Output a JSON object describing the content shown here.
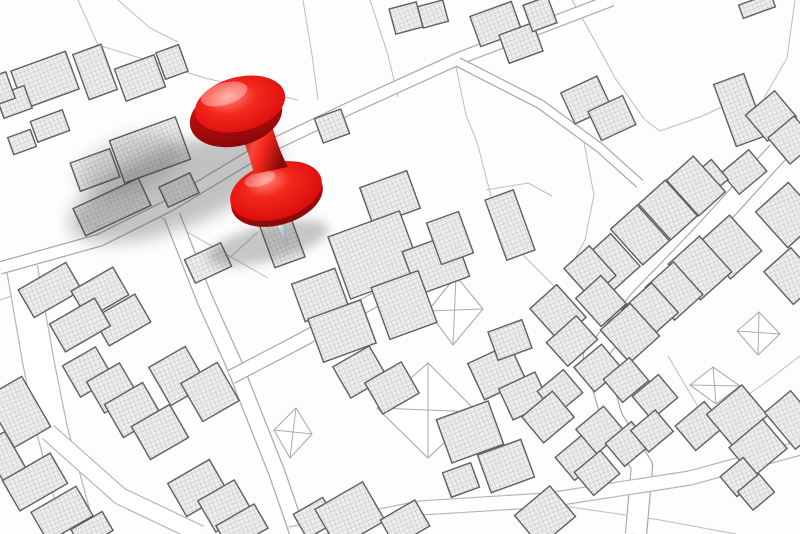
{
  "meta": {
    "alt": "Imaginary cadastral city map with hatched building footprints, parcel lines, white roads, X-marked vacant plots and a red pushpin marking a location near the top left",
    "width": 800,
    "height": 534
  },
  "palette": {
    "background": "#fdfdfd",
    "parcel_line": "#bdbdbd",
    "road_fill": "#ffffff",
    "road_casing": "#a8a8a8",
    "road_casing_wide": "#b5b5b5",
    "building_stroke": "#5f5f5f",
    "hatch_bg": "#ededed",
    "hatch_line": "#bcbcbc",
    "xplot_stroke": "#ababab",
    "shadow_color": "#3a3a3a",
    "pin_red_bright": "#f3281c",
    "pin_red_mid": "#e01010",
    "pin_red_dark": "#a50c0c",
    "pin_red_deep": "#8a0808",
    "pin_highlight": "#ff8b7c",
    "needle_light": "#ffffff",
    "needle_dark": "#aab1b8"
  },
  "map": {
    "parcel_lines": [
      [
        78,
        0,
        98,
        45,
        205,
        78,
        298,
        100
      ],
      [
        118,
        0,
        150,
        28,
        178,
        42
      ],
      [
        303,
        0,
        312,
        55,
        318,
        100
      ],
      [
        370,
        0,
        388,
        55,
        398,
        97
      ],
      [
        455,
        62,
        466,
        115,
        477,
        142
      ],
      [
        477,
        142,
        492,
        200,
        520,
        252,
        558,
        290
      ],
      [
        572,
        0,
        600,
        50,
        615,
        78,
        645,
        120,
        660,
        131
      ],
      [
        660,
        131,
        700,
        117,
        724,
        106,
        748,
        92
      ],
      [
        795,
        0,
        787,
        58,
        764,
        98
      ],
      [
        583,
        137,
        594,
        195,
        585,
        240,
        570,
        268
      ],
      [
        486,
        190,
        528,
        183,
        552,
        196
      ],
      [
        152,
        212,
        268,
        278
      ],
      [
        258,
        232,
        196,
        288
      ],
      [
        532,
        497,
        640,
        482,
        800,
        447
      ],
      [
        563,
        506,
        660,
        520,
        736,
        534
      ],
      [
        668,
        356,
        688,
        390,
        700,
        410
      ],
      [
        800,
        356,
        762,
        385,
        740,
        400
      ],
      [
        0,
        300,
        22,
        292
      ],
      [
        425,
        250,
        428,
        272
      ]
    ],
    "roads": [
      {
        "points": [
          22,
          268,
          38,
          360,
          52,
          430,
          80,
          534
        ],
        "width": 30,
        "wide": true
      },
      {
        "points": [
          48,
          432,
          120,
          496,
          200,
          534
        ],
        "width": 16,
        "wide": true
      },
      {
        "points": [
          0,
          268,
          100,
          240,
          170,
          205,
          258,
          152,
          350,
          108,
          460,
          58,
          612,
          0
        ],
        "width": 11,
        "wide": false
      },
      {
        "points": [
          458,
          62,
          540,
          104,
          600,
          148,
          640,
          184
        ],
        "width": 8,
        "wide": false
      },
      {
        "points": [
          172,
          216,
          205,
          300,
          233,
          362,
          277,
          473,
          298,
          534
        ],
        "width": 15,
        "wide": false
      },
      {
        "points": [
          231,
          377,
          300,
          341,
          380,
          297,
          422,
          277
        ],
        "width": 13,
        "wide": false
      },
      {
        "points": [
          778,
          152,
          700,
          238,
          640,
          300,
          594,
          356,
          612,
          418,
          642,
          466,
          636,
          534
        ],
        "width": 20,
        "wide": false
      },
      {
        "points": [
          290,
          534,
          420,
          508,
          548,
          500,
          690,
          478,
          800,
          448
        ],
        "width": 13,
        "wide": true
      }
    ],
    "buildings": [
      [
        45,
        80,
        58,
        40,
        -20
      ],
      [
        95,
        72,
        30,
        48,
        -20
      ],
      [
        140,
        78,
        42,
        34,
        -20
      ],
      [
        172,
        62,
        24,
        28,
        -20
      ],
      [
        14,
        102,
        30,
        24,
        -20
      ],
      [
        50,
        126,
        34,
        22,
        -20
      ],
      [
        22,
        142,
        24,
        18,
        -20
      ],
      [
        2,
        88,
        18,
        28,
        -20
      ],
      [
        150,
        150,
        70,
        45,
        -20
      ],
      [
        95,
        170,
        42,
        30,
        -20
      ],
      [
        112,
        207,
        72,
        30,
        -25
      ],
      [
        179,
        190,
        34,
        22,
        -25
      ],
      [
        208,
        263,
        40,
        26,
        -25
      ],
      [
        292,
        194,
        36,
        30,
        -20
      ],
      [
        280,
        235,
        32,
        58,
        -20
      ],
      [
        50,
        290,
        55,
        32,
        -30
      ],
      [
        100,
        293,
        48,
        32,
        -30
      ],
      [
        122,
        320,
        48,
        32,
        -30
      ],
      [
        80,
        325,
        52,
        32,
        -30
      ],
      [
        18,
        412,
        42,
        58,
        -30
      ],
      [
        5,
        458,
        26,
        46,
        -30
      ],
      [
        35,
        482,
        55,
        35,
        -30
      ],
      [
        62,
        514,
        52,
        34,
        -30
      ],
      [
        92,
        530,
        36,
        22,
        -30
      ],
      [
        88,
        372,
        38,
        36,
        -30
      ],
      [
        112,
        388,
        38,
        36,
        -30
      ],
      [
        133,
        410,
        44,
        38,
        -30
      ],
      [
        160,
        432,
        44,
        38,
        -30
      ],
      [
        178,
        376,
        42,
        44,
        -30
      ],
      [
        210,
        392,
        42,
        44,
        -30
      ],
      [
        198,
        488,
        48,
        38,
        -30
      ],
      [
        225,
        506,
        42,
        36,
        -30
      ],
      [
        242,
        527,
        44,
        28,
        -30
      ],
      [
        360,
        372,
        42,
        36,
        -30
      ],
      [
        392,
        388,
        42,
        36,
        -30
      ],
      [
        315,
        518,
        34,
        28,
        -30
      ],
      [
        350,
        515,
        55,
        45,
        -30
      ],
      [
        405,
        523,
        40,
        30,
        -30
      ],
      [
        470,
        432,
        55,
        46,
        -20
      ],
      [
        506,
        466,
        46,
        40,
        -20
      ],
      [
        461,
        480,
        30,
        26,
        -20
      ],
      [
        497,
        372,
        46,
        40,
        -25
      ],
      [
        524,
        396,
        40,
        34,
        -25
      ],
      [
        390,
        198,
        50,
        40,
        -20
      ],
      [
        375,
        255,
        76,
        66,
        -20
      ],
      [
        436,
        264,
        55,
        46,
        -20
      ],
      [
        450,
        238,
        34,
        44,
        -20
      ],
      [
        404,
        305,
        50,
        55,
        -20
      ],
      [
        320,
        295,
        46,
        40,
        -20
      ],
      [
        342,
        331,
        56,
        46,
        -20
      ],
      [
        510,
        225,
        30,
        64,
        -20
      ],
      [
        510,
        340,
        36,
        30,
        -20
      ],
      [
        406,
        18,
        28,
        26,
        -15
      ],
      [
        433,
        14,
        26,
        22,
        -15
      ],
      [
        332,
        126,
        28,
        26,
        -20
      ],
      [
        496,
        24,
        44,
        32,
        -20
      ],
      [
        521,
        43,
        36,
        30,
        -20
      ],
      [
        540,
        14,
        26,
        28,
        -20
      ],
      [
        586,
        100,
        40,
        34,
        -25
      ],
      [
        612,
        118,
        38,
        32,
        -25
      ],
      [
        740,
        110,
        32,
        66,
        -20
      ],
      [
        771,
        116,
        38,
        34,
        -40
      ],
      [
        792,
        140,
        34,
        34,
        -40
      ],
      [
        744,
        172,
        36,
        28,
        -40
      ],
      [
        706,
        181,
        36,
        26,
        -40
      ],
      [
        757,
        6,
        34,
        14,
        -20
      ],
      [
        612,
        262,
        36,
        44,
        -42
      ],
      [
        640,
        235,
        36,
        48,
        -42
      ],
      [
        668,
        210,
        36,
        48,
        -42
      ],
      [
        696,
        186,
        36,
        48,
        -42
      ],
      [
        590,
        272,
        34,
        40,
        -42
      ],
      [
        601,
        301,
        34,
        38,
        -42
      ],
      [
        558,
        313,
        36,
        44,
        -42
      ],
      [
        572,
        341,
        40,
        32,
        -42
      ],
      [
        788,
        215,
        44,
        48,
        -42
      ],
      [
        730,
        247,
        42,
        48,
        -42
      ],
      [
        700,
        268,
        42,
        48,
        -42
      ],
      [
        674,
        291,
        38,
        44,
        -42
      ],
      [
        650,
        311,
        40,
        40,
        -42
      ],
      [
        630,
        333,
        40,
        44,
        -42
      ],
      [
        792,
        276,
        36,
        44,
        -42
      ],
      [
        598,
        368,
        36,
        32,
        -40
      ],
      [
        626,
        380,
        34,
        30,
        -40
      ],
      [
        560,
        392,
        34,
        30,
        -40
      ],
      [
        548,
        417,
        40,
        34,
        -40
      ],
      [
        655,
        397,
        34,
        30,
        -40
      ],
      [
        600,
        430,
        36,
        32,
        -40
      ],
      [
        628,
        444,
        34,
        30,
        -40
      ],
      [
        652,
        431,
        32,
        28,
        -40
      ],
      [
        578,
        458,
        34,
        30,
        -40
      ],
      [
        597,
        473,
        34,
        30,
        -40
      ],
      [
        700,
        426,
        38,
        32,
        -40
      ],
      [
        737,
        415,
        46,
        40,
        -40
      ],
      [
        758,
        448,
        44,
        38,
        -40
      ],
      [
        740,
        477,
        30,
        26,
        -40
      ],
      [
        756,
        492,
        28,
        24,
        -40
      ],
      [
        545,
        516,
        46,
        40,
        -40
      ],
      [
        793,
        420,
        34,
        48,
        -40
      ]
    ],
    "x_plots": [
      [
        377,
        408,
        428,
        363,
        477,
        412,
        428,
        458
      ],
      [
        274,
        430,
        296,
        408,
        312,
        434,
        290,
        458
      ],
      [
        690,
        385,
        713,
        367,
        740,
        386,
        716,
        404
      ],
      [
        737,
        331,
        759,
        312,
        780,
        334,
        758,
        355
      ],
      [
        428,
        311,
        456,
        276,
        483,
        309,
        453,
        345
      ]
    ]
  },
  "pin": {
    "shadow": [
      {
        "cx": 175,
        "cy": 188,
        "rx": 112,
        "ry": 40,
        "rot": -21,
        "op": 0.3,
        "blur": "b8"
      },
      {
        "cx": 130,
        "cy": 165,
        "rx": 55,
        "ry": 28,
        "rot": -21,
        "op": 0.18,
        "blur": "b8"
      },
      {
        "cx": 268,
        "cy": 243,
        "rx": 62,
        "ry": 18,
        "rot": -14,
        "op": 0.28,
        "blur": "b5"
      }
    ],
    "needle_points": "271,212 283,208 287,246",
    "base_rim": {
      "cx": 277,
      "cy": 197,
      "rx": 47,
      "ry": 28,
      "rot": -16
    },
    "base": {
      "cx": 276,
      "cy": 191,
      "rx": 47,
      "ry": 28,
      "rot": -16
    },
    "base_highlight": {
      "cx": 260,
      "cy": 179,
      "rx": 16,
      "ry": 7,
      "rot": -16,
      "op": 0.3
    },
    "neck_path": "M 239,128 C 247,150 250,158 254,174 L 288,167 C 279,150 275,136 271,122 Z",
    "head_rim": {
      "cx": 236,
      "cy": 116,
      "rx": 47,
      "ry": 30,
      "rot": -14
    },
    "head": {
      "cx": 240,
      "cy": 104,
      "rx": 46,
      "ry": 27,
      "rot": -14
    },
    "head_highlight": {
      "cx": 224,
      "cy": 94,
      "rx": 24,
      "ry": 11,
      "rot": -16,
      "op": 0.35
    }
  }
}
